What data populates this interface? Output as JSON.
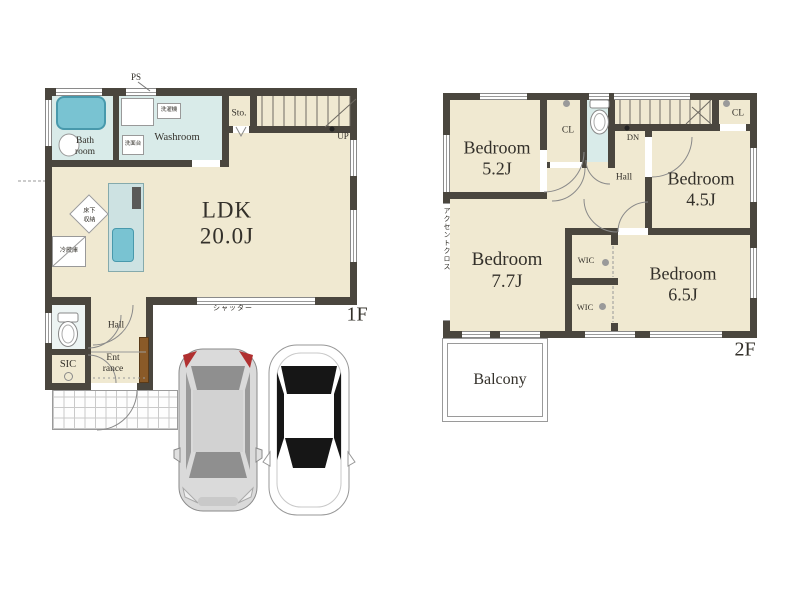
{
  "colors": {
    "wall": "#4a463e",
    "floor": "#f0e9d1",
    "wet": "#d9ebe9",
    "fixture": "#79c3d2",
    "ink": "#33302a",
    "door_brown": "#8a5a28"
  },
  "floor1": {
    "label": "1F",
    "ps": "PS",
    "bath": [
      "Bath",
      "room"
    ],
    "washroom": "Washroom",
    "washer": "洗濯機",
    "vanity": "洗面台",
    "storage": "Sto.",
    "up": "UP",
    "ldk": [
      "LDK",
      "20.0J"
    ],
    "underfloor_storage": "床下収納",
    "refrigerator": "冷蔵庫",
    "hall": "Hall",
    "sic": "SIC",
    "entrance": [
      "Ent",
      "rance"
    ],
    "shutter": "シャッター"
  },
  "floor2": {
    "label": "2F",
    "dn": "DN",
    "hall": "Hall",
    "closets": [
      "CL",
      "CL"
    ],
    "wic": [
      "WIC",
      "WIC"
    ],
    "bedrooms": [
      {
        "name": "Bedroom",
        "size": "5.2J"
      },
      {
        "name": "Bedroom",
        "size": "4.5J"
      },
      {
        "name": "Bedroom",
        "size": "7.7J"
      },
      {
        "name": "Bedroom",
        "size": "6.5J"
      }
    ],
    "accent_wall": "アクセントクロス",
    "balcony": "Balcony"
  }
}
